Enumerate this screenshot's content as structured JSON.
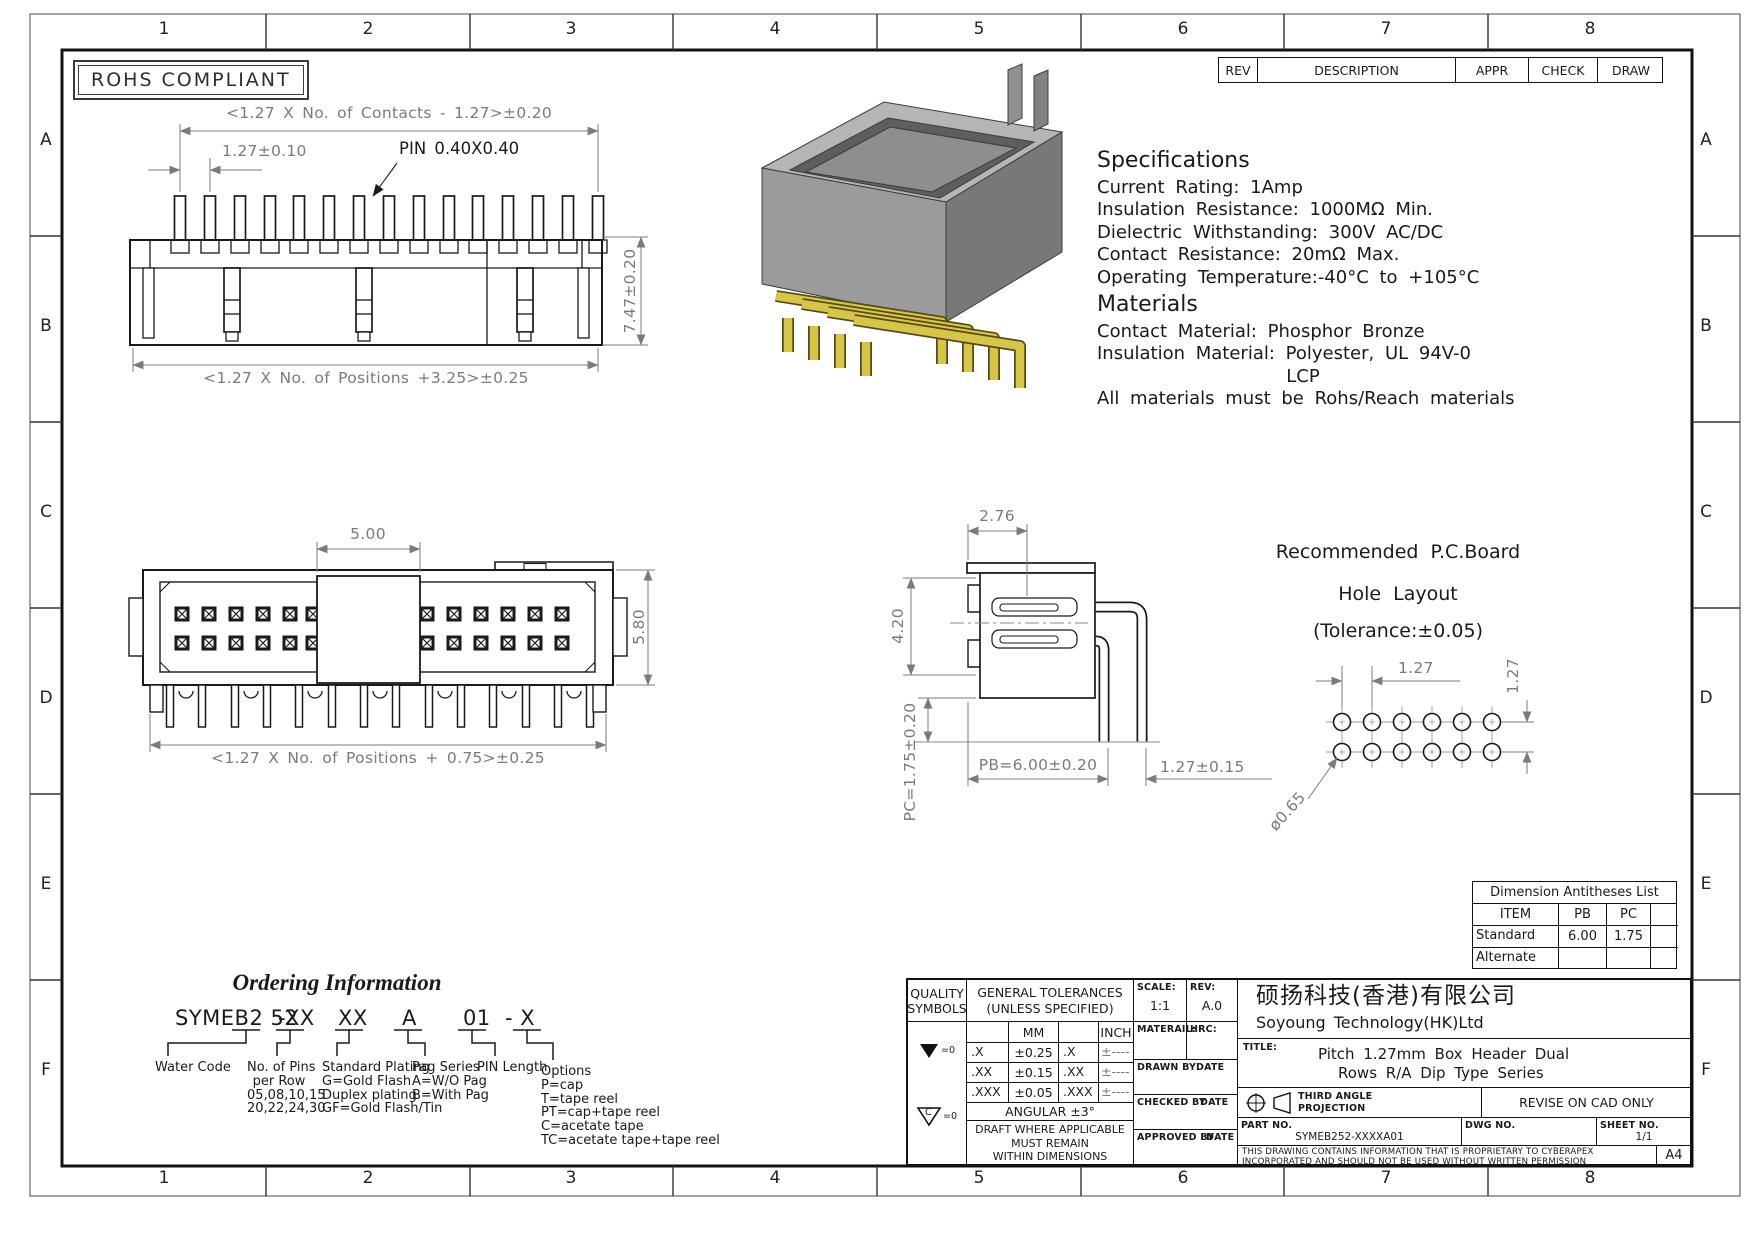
{
  "sheet": {
    "zone_cols": [
      "1",
      "2",
      "3",
      "4",
      "5",
      "6",
      "7",
      "8"
    ],
    "zone_rows": [
      "A",
      "B",
      "C",
      "D",
      "E",
      "F"
    ],
    "rohs": "ROHS COMPLIANT"
  },
  "rev_strip": {
    "rev": "REV",
    "description": "DESCRIPTION",
    "appr": "APPR",
    "check": "CHECK",
    "draw": "DRAW"
  },
  "dims": {
    "d1_contacts": "<1.27 X No. of Contacts - 1.27>±0.20",
    "d1_pitch": "1.27±0.10",
    "d1_pin": "PIN 0.40X0.40",
    "d1_height": "7.47±0.20",
    "d1_positions": "<1.27 X No. of Positions +3.25>±0.25",
    "d2_key": "5.00",
    "d2_height": "5.80",
    "d2_positions": "<1.27 X No. of Positions + 0.75>±0.25",
    "d3_top": "2.76",
    "d3_side": "4.20",
    "d3_pb": "PB=6.00±0.20",
    "d3_pc": "PC=1.75±0.20",
    "d3_pitch": "1.27±0.15"
  },
  "specs": {
    "title": "Specifications",
    "l1": "Current Rating: 1Amp",
    "l2": "Insulation Resistance: 1000MΩ Min.",
    "l3": "Dielectric Withstanding: 300V AC/DC",
    "l4": "Contact Resistance: 20mΩ Max.",
    "l5": "Operating Temperature:-40°C to +105°C",
    "materials_title": "Materials",
    "m1": "Contact Material: Phosphor Bronze",
    "m2": "Insulation Material: Polyester, UL 94V-0",
    "m3": "LCP",
    "note": "All materials must be Rohs/Reach materials"
  },
  "hole_layout": {
    "title1": "Recommended P.C.Board",
    "title2": "Hole Layout",
    "title3": "(Tolerance:±0.05)",
    "pitch_h": "1.27",
    "pitch_v": "1.27",
    "dia": "ø0.65"
  },
  "antitheses": {
    "title": "Dimension Antitheses List",
    "item": "ITEM",
    "pb": "PB",
    "pc": "PC",
    "standard": "Standard",
    "standard_pb": "6.00",
    "standard_pc": "1.75",
    "alternate": "Alternate",
    "alternate_pb": "",
    "alternate_pc": ""
  },
  "ordering": {
    "title": "Ordering Information",
    "code1": "SYMEB2 52",
    "code2": "-XX",
    "code3": "XX",
    "code4": "A",
    "code5": "01",
    "code6": "- X",
    "water_code": "Water Code",
    "pins1": "No. of Pins",
    "pins2": "per Row",
    "pins3": "05,08,10,15",
    "pins4": "20,22,24,30",
    "plating1": "Standard Plating",
    "plating2": "G=Gold Flash",
    "plating3": "Duplex plating",
    "plating4": "GF=Gold Flash/Tin",
    "pag1": "Pag Series",
    "pag2": "A=W/O Pag",
    "pag3": "B=With Pag",
    "pin_length": "PIN Length",
    "opt1": "Options",
    "opt2": "P=cap",
    "opt3": "T=tape reel",
    "opt4": "PT=cap+tape reel",
    "opt5": "C=acetate tape",
    "opt6": "TC=acetate tape+tape reel"
  },
  "title_block": {
    "quality1": "QUALITY",
    "quality2": "SYMBOLS",
    "s1_note": "=0",
    "s2_c": "C",
    "s2_note": "=0",
    "tol_title1": "GENERAL TOLERANCES",
    "tol_title2": "(UNLESS SPECIFIED)",
    "mm": "MM",
    "inch": "INCH",
    "rows": [
      [
        ".X",
        "±0.25",
        ".X",
        "±----"
      ],
      [
        ".XX",
        "±0.15",
        ".XX",
        "±----"
      ],
      [
        ".XXX",
        "±0.05",
        ".XXX",
        "±----"
      ]
    ],
    "angular": "ANGULAR ±3°",
    "draft1": "DRAFT WHERE APPLICABLE",
    "draft2": "MUST REMAIN",
    "draft3": "WITHIN DIMENSIONS",
    "scale_label": "SCALE:",
    "scale": "1:1",
    "rev_label": "REV:",
    "rev": "A.0",
    "material_label": "MATERAIL:",
    "hrc_label": "HRC:",
    "drawn": "DRAWN BY",
    "checked": "CHECKED BY",
    "approved": "APPROVED BY",
    "date": "DATE",
    "company_cn": "硕扬科技(香港)有限公司",
    "company_en": "Soyoung Technology(HK)Ltd",
    "title_label": "TITLE:",
    "title1": "Pitch 1.27mm Box Header Dual",
    "title2": "Rows R/A Dip Type Series",
    "projection1": "THIRD ANGLE",
    "projection2": "PROJECTION",
    "revise": "REVISE ON CAD ONLY",
    "part_label": "PART NO.",
    "part_no": "SYMEB252-XXXXA01",
    "dwg_label": "DWG NO.",
    "sheet_label": "SHEET NO.",
    "sheet_no": "1/1",
    "disclaimer1": "THIS DRAWING CONTAINS INFORMATION THAT IS PROPRIETARY TO CYBERAPEX",
    "disclaimer2": "INCORPORATED AND SHOULD NOT BE USED WITHOUT WRITTEN PERMISSION",
    "paper": "A4"
  }
}
